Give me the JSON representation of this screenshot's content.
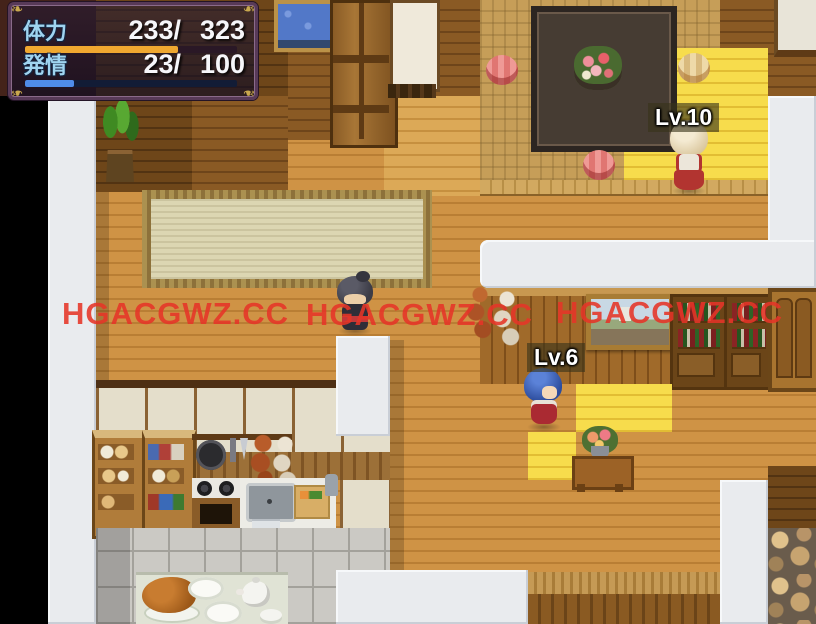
{
  "hud": {
    "rows": [
      {
        "label": "体力",
        "current": "233/",
        "max": "323",
        "percent": 72,
        "fill": "#f0a830",
        "track": "#2a1826"
      },
      {
        "label": "発情",
        "current": "23/",
        "max": "100",
        "percent": 23,
        "fill": "#4f8ce8",
        "track": "#121c36"
      }
    ]
  },
  "badges": {
    "npc_blonde": "Lv.10",
    "npc_blue": "Lv.6"
  },
  "watermark": {
    "text": "HGACGWZ.CC",
    "color": "#e63528"
  },
  "palette": {
    "floor": "#c98e41",
    "floor_lit": "#f6d843",
    "tatami": "#c69e58",
    "wall_face": "#9c6626",
    "white_wall": "#e9ebee",
    "rug": "#dcd6b2",
    "void": "#000000",
    "hud_frame": "#583a58",
    "hud_gold": "#c9a84e"
  }
}
